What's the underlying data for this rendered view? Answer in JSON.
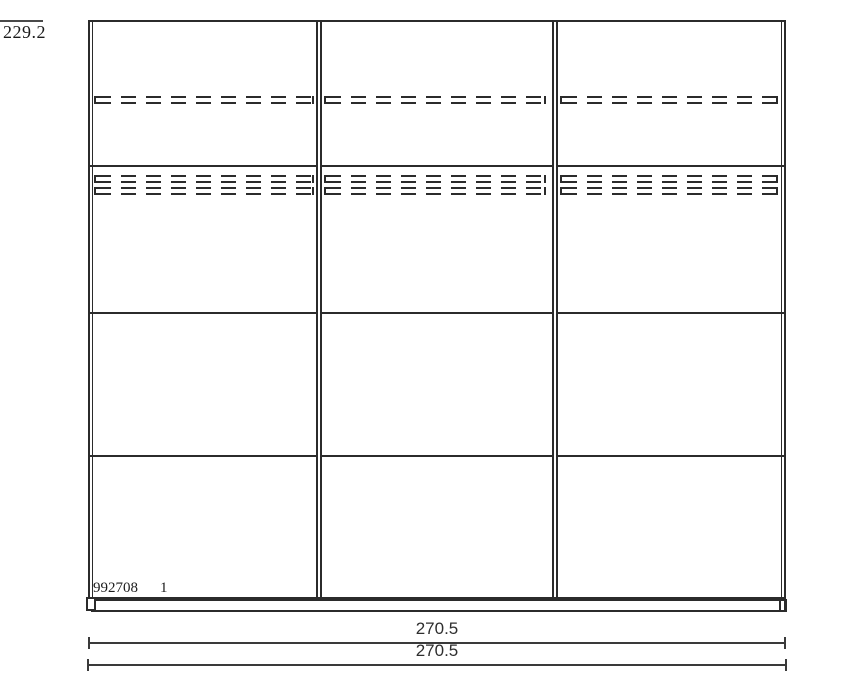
{
  "drawing": {
    "kind": "wardrobe front elevation",
    "line_color": "#2b2b2b",
    "dimension_line_color": "#3a3a3a",
    "text_color": "#1c1c1c",
    "background_color": "#ffffff"
  },
  "dimensions": {
    "height": "229.2",
    "width_top": "270.5",
    "width_bottom": "270.5"
  },
  "title_block": {
    "drawing_number": "992708",
    "sheet_number": "1"
  },
  "structure": {
    "sliding_doors": 3,
    "panels_per_door": 4,
    "hidden_shelf_rows": 3
  }
}
